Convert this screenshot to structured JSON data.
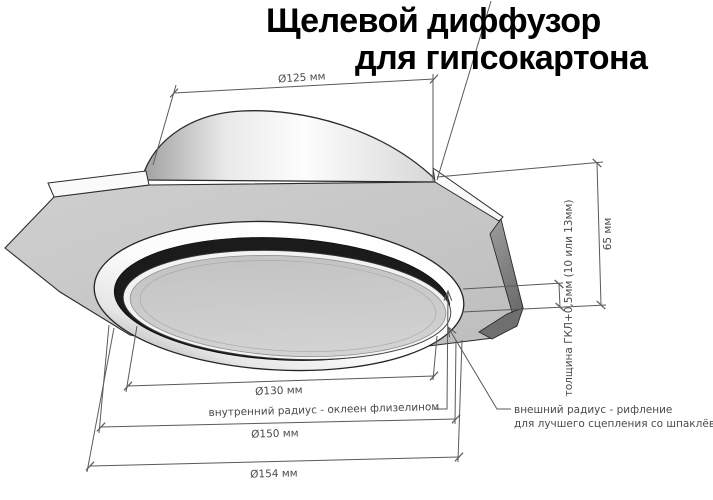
{
  "title": {
    "line1": "Щелевой диффузор",
    "line2": "для гипсокартона"
  },
  "annotations": {
    "top_diameter": "Ø125 мм",
    "height": "65 мм",
    "board_thickness": "толщина ГКЛ+0,5мм (10 или 13мм)",
    "disc_diameter": "Ø130 мм",
    "inner_radius_note": "внутренний радиус - оклеен флизелином",
    "ring_diameter": "Ø150 мм",
    "outer_diameter": "Ø154 мм",
    "outer_radius_note_line1": "внешний радиус - рифление",
    "outer_radius_note_line2": "для лучшего сцепления со шпаклёвкой"
  },
  "colors": {
    "background": "#ffffff",
    "title_text": "#000000",
    "dimension_lines": "#5a5a5a",
    "dimension_text": "#4a4a4a",
    "outline": "#2b2b2b",
    "plate_underside": "#c6c6c6",
    "plate_edge_band": "#fafafa",
    "plate_side_face": "#7a7a7a",
    "ring": "#ffffff",
    "slot_gap": "#1b1b1b",
    "center_disc": "#c9c9c9"
  }
}
